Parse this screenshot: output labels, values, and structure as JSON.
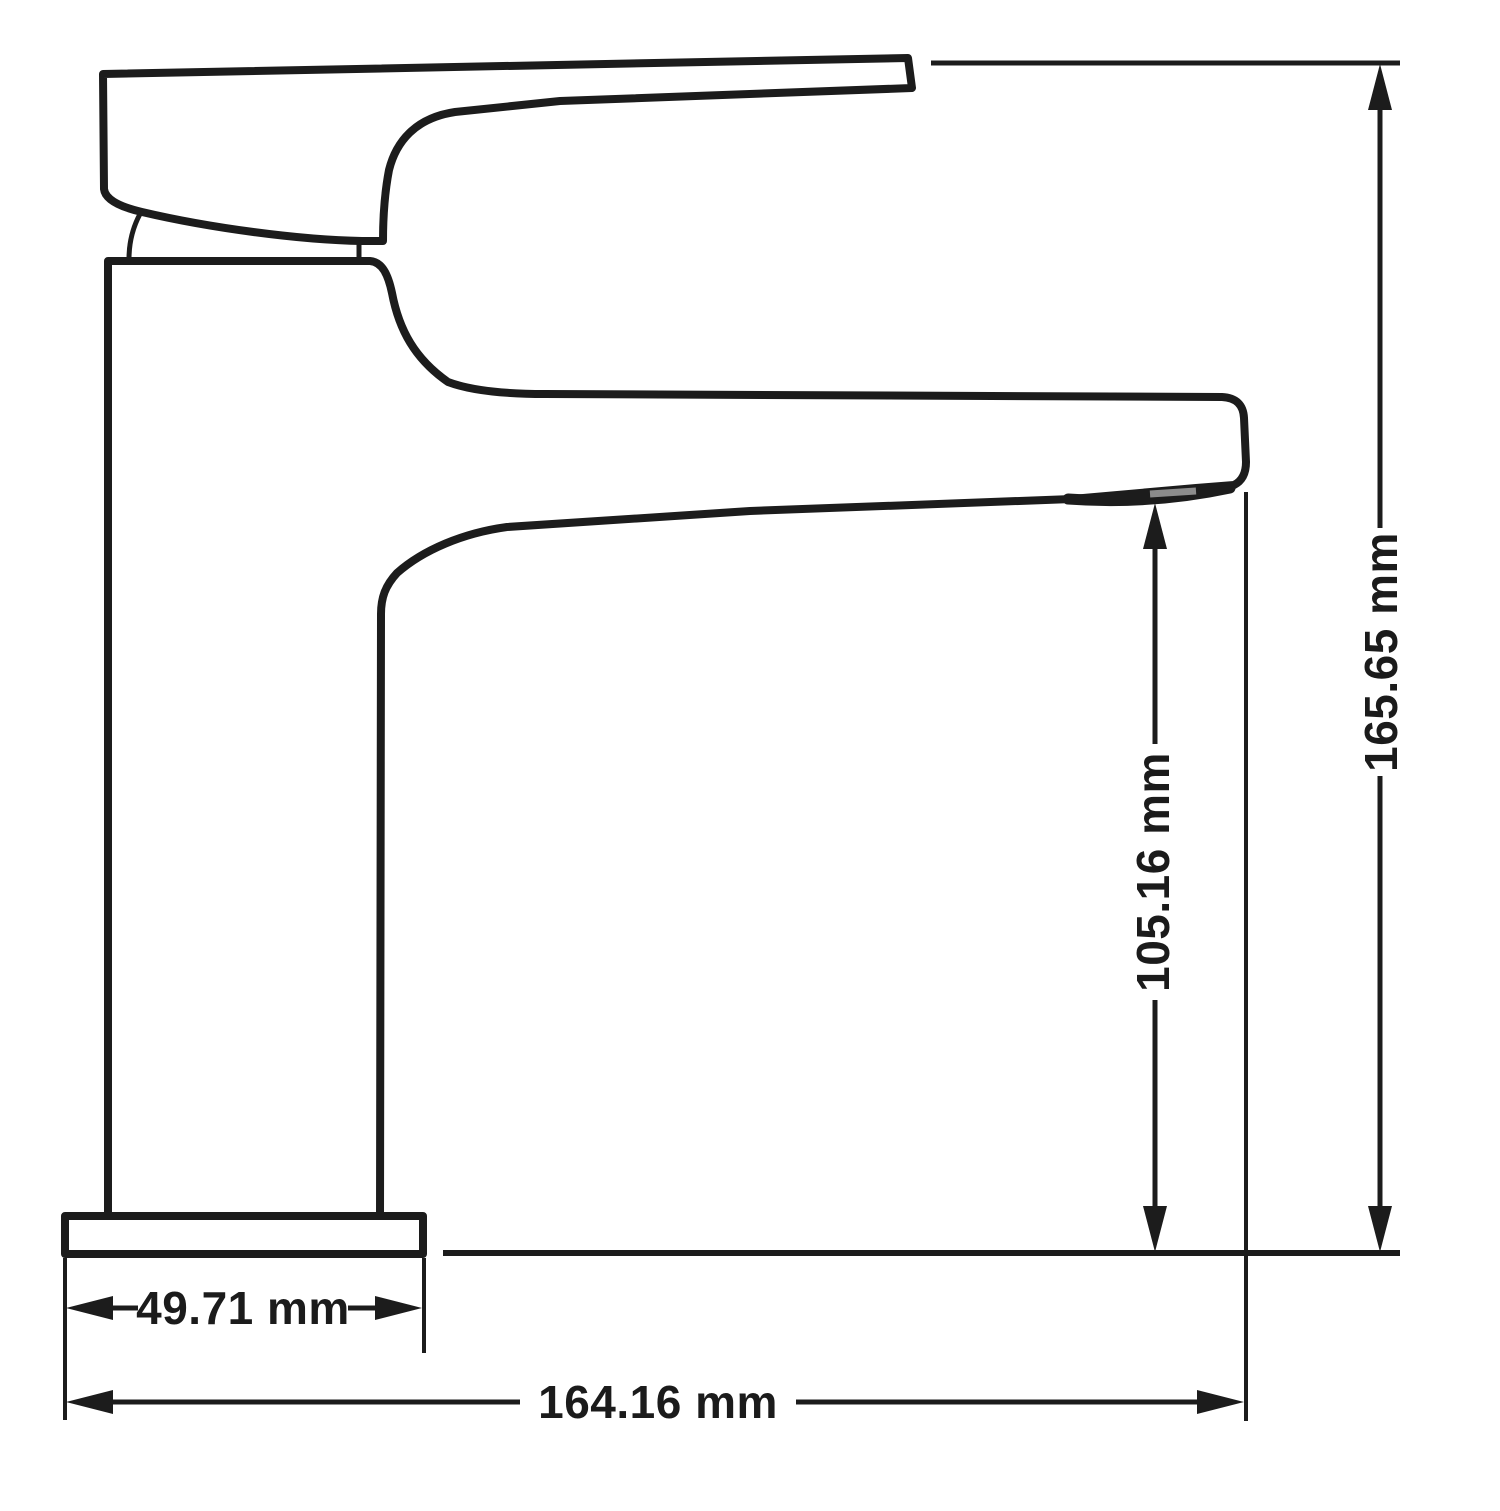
{
  "drawing": {
    "object": "single-lever-basin-faucet-side-elevation",
    "background_color": "#ffffff",
    "line_color": "#1c1c1c",
    "aerator_color": "#8c8c8c",
    "unit": "mm",
    "dimensions": {
      "overall_height": {
        "label": "165.65 mm",
        "value": "165.65",
        "unit": "mm",
        "orientation": "vertical"
      },
      "spout_height": {
        "label": "105.16 mm",
        "value": "105.16",
        "unit": "mm",
        "orientation": "vertical"
      },
      "base_width": {
        "label": "49.71 mm",
        "value": "49.71",
        "unit": "mm",
        "orientation": "horizontal"
      },
      "overall_length": {
        "label": "164.16 mm",
        "value": "164.16",
        "unit": "mm",
        "orientation": "horizontal"
      }
    }
  }
}
